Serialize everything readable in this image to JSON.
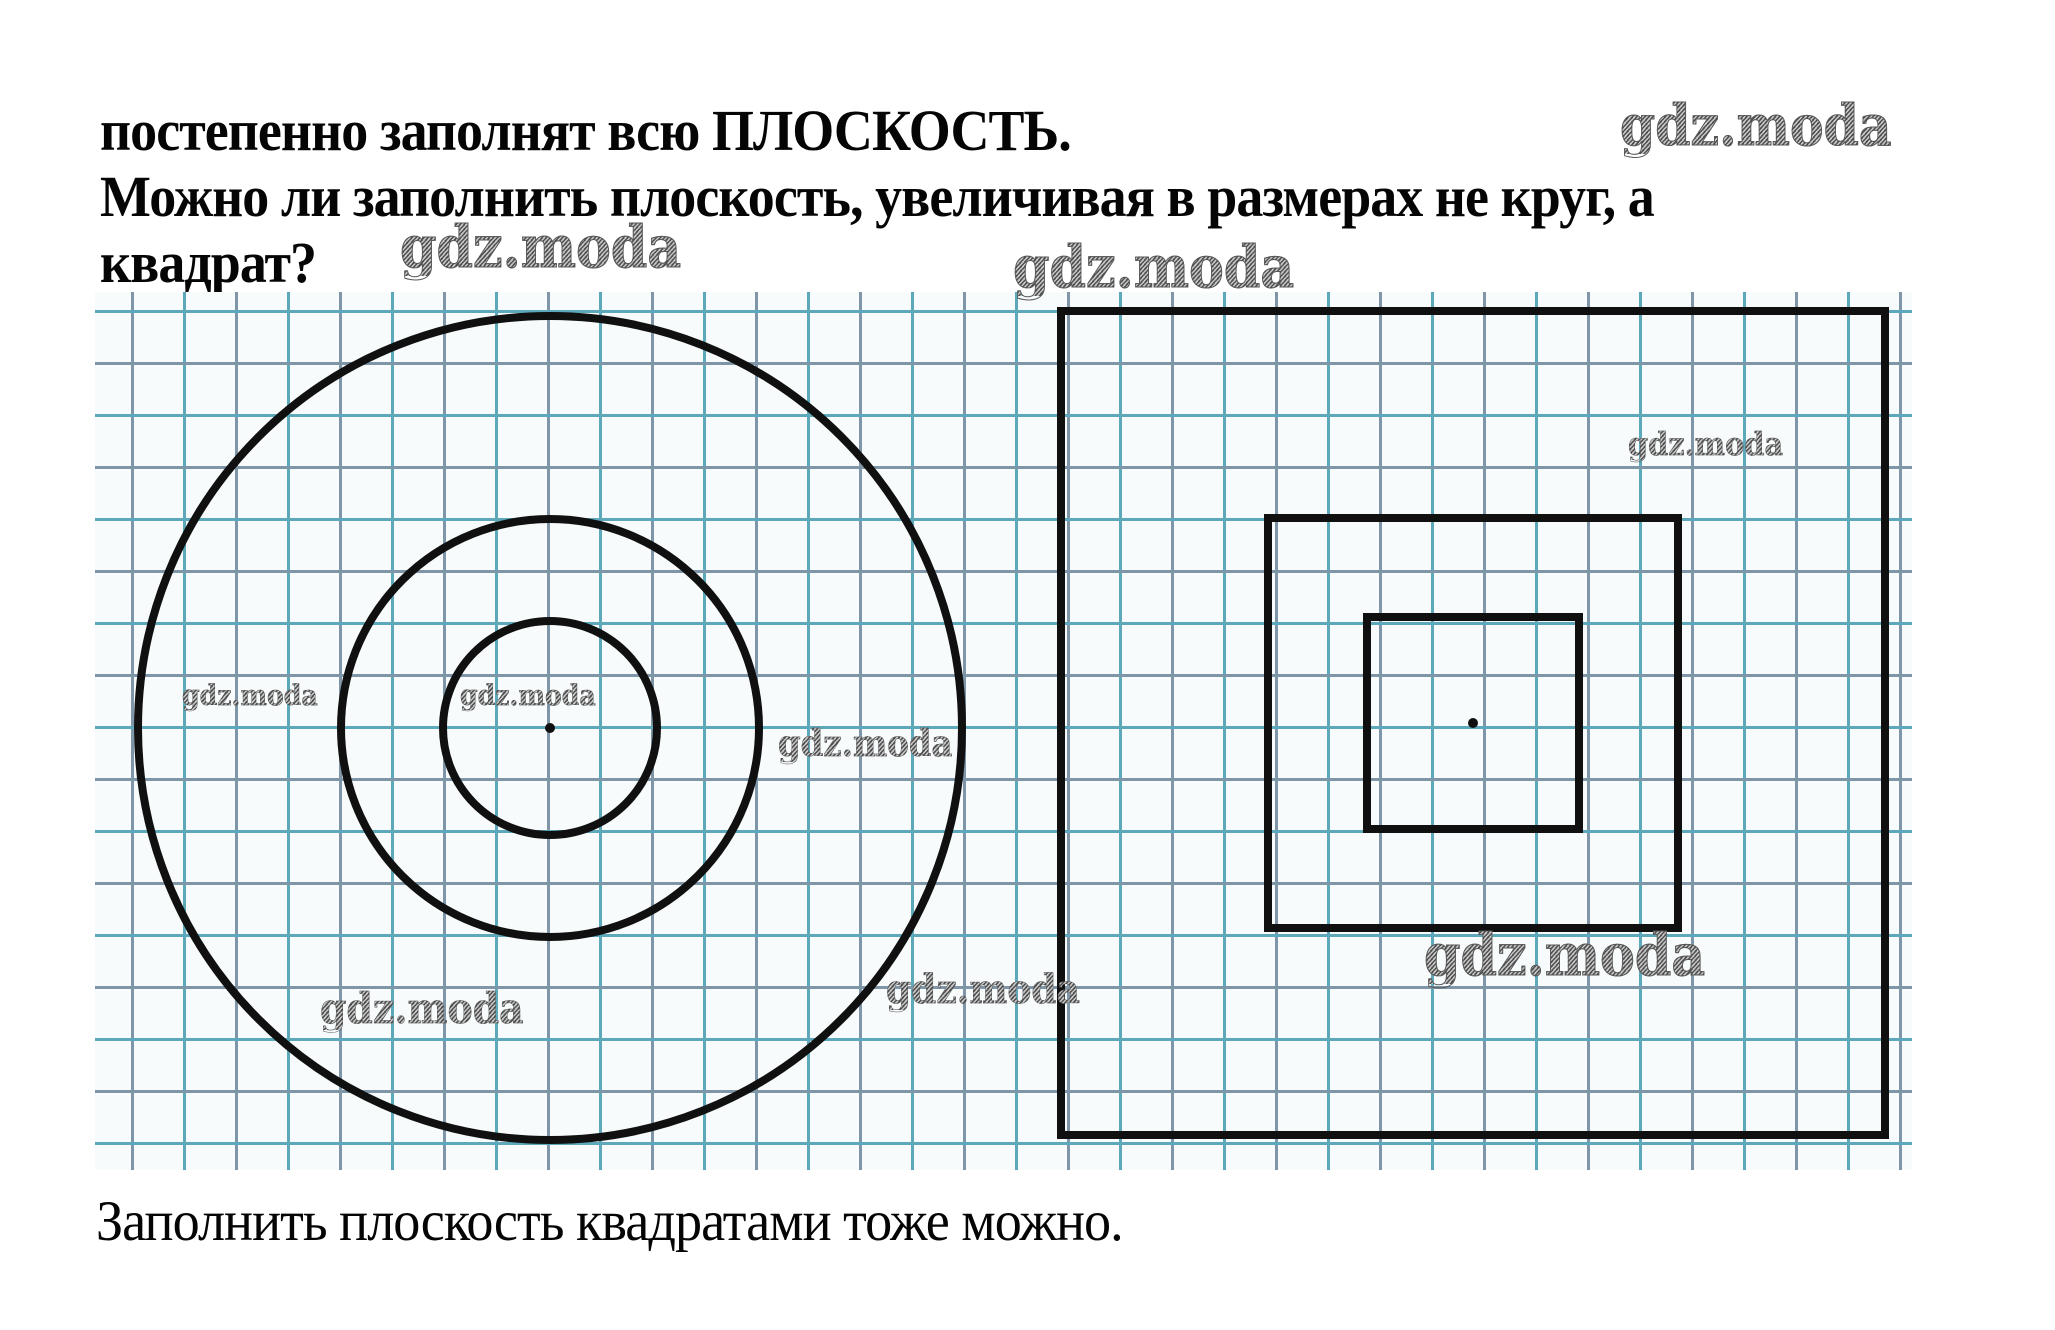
{
  "page": {
    "paragraph_top": "постепенно заполнят всю ПЛОСКОСТЬ.",
    "question_line1": "Можно ли заполнить плоскость, увеличивая в размерах не круг, а",
    "question_line2": "квадрат?",
    "answer": "Заполнить плоскость квадратами тоже можно."
  },
  "watermarks": [
    {
      "text": "gdz.moda",
      "location": "header-right"
    },
    {
      "text": "gdz.moda",
      "location": "beside-question"
    },
    {
      "text": "gdz.moda",
      "location": "above-squares-left"
    },
    {
      "text": "gdz.moda",
      "location": "circles-left"
    },
    {
      "text": "gdz.moda",
      "location": "circles-center"
    },
    {
      "text": "gdz.moda",
      "location": "circles-right"
    },
    {
      "text": "gdz.moda",
      "location": "circles-bottom-left"
    },
    {
      "text": "gdz.moda",
      "location": "between-figures"
    },
    {
      "text": "gdz.moda",
      "location": "squares-top-right"
    },
    {
      "text": "gdz.moda",
      "location": "squares-bottom"
    }
  ],
  "figure": {
    "description": "Two drawings on squared graph paper: three concentric circles with a center point (left) and three concentric squares with a center point (right); each successive shape doubles in size (2, 4, 8 grid cells).",
    "grid": {
      "left": 95,
      "top": 292,
      "width": 1817,
      "height": 878,
      "cell_px": 52,
      "paper_color": "#f7fbfc",
      "line_color_a": "#5da9bb",
      "line_color_b": "#7f96a9",
      "shape_stroke_color": "#101010",
      "shape_stroke_width": 8
    },
    "circles": {
      "cx": 455,
      "cy": 436,
      "radii_px": [
        107,
        209,
        412
      ],
      "center_dot_radius": 5
    },
    "squares": {
      "cx": 1378,
      "cy": 431,
      "half_sides_px": [
        106,
        205,
        412
      ],
      "center_dot_radius": 5
    }
  },
  "colors": {
    "background": "#ffffff",
    "text": "#050505",
    "watermark_gray": "#8a8a8a",
    "grid_teal": "#5da9bb",
    "grid_slate": "#7f96a9",
    "paper": "#f7fbfc"
  }
}
